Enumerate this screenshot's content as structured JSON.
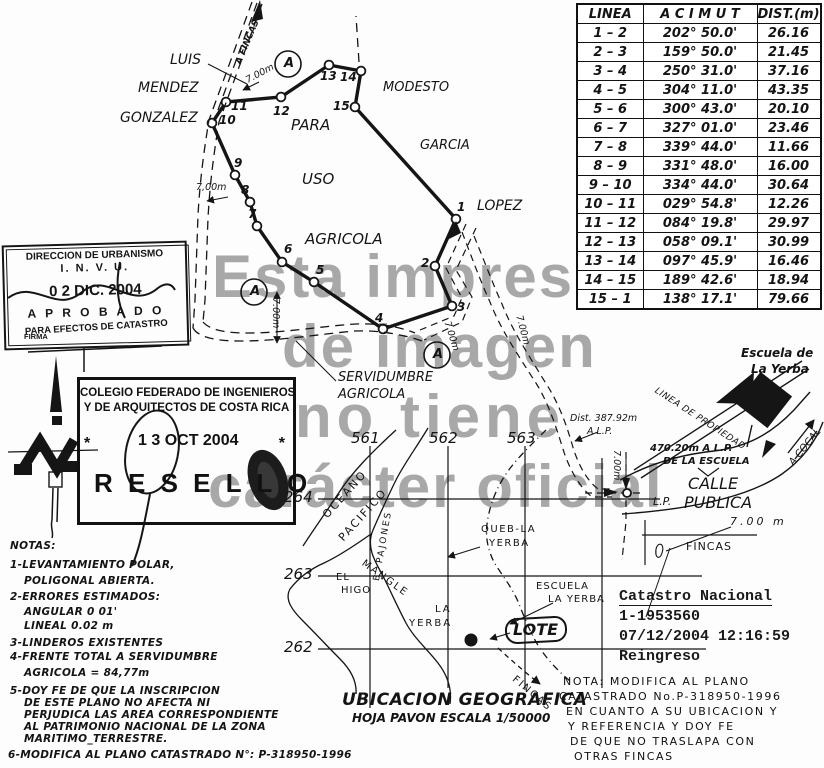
{
  "watermark": {
    "line1": "Esta impresión",
    "line2": "de imagen",
    "line3": "no tiene",
    "line4": "carácter oficial"
  },
  "survey_table": {
    "col_linea": "LINEA",
    "col_acimut": "A C I M U T",
    "col_dist": "DIST.(m)",
    "rows": [
      {
        "linea": "1 – 2",
        "acimut": "202° 50.0'",
        "dist": "26.16"
      },
      {
        "linea": "2 – 3",
        "acimut": "159° 50.0'",
        "dist": "21.45"
      },
      {
        "linea": "3 – 4",
        "acimut": "250° 31.0'",
        "dist": "37.16"
      },
      {
        "linea": "4 – 5",
        "acimut": "304° 11.0'",
        "dist": "43.35"
      },
      {
        "linea": "5 – 6",
        "acimut": "300° 43.0'",
        "dist": "20.10"
      },
      {
        "linea": "6 – 7",
        "acimut": "327° 01.0'",
        "dist": "23.46"
      },
      {
        "linea": "7 – 8",
        "acimut": "339° 44.0'",
        "dist": "11.66"
      },
      {
        "linea": "8 – 9",
        "acimut": "331° 48.0'",
        "dist": "16.00"
      },
      {
        "linea": "9 – 10",
        "acimut": "334° 44.0'",
        "dist": "30.64"
      },
      {
        "linea": "10 – 11",
        "acimut": "029° 54.8'",
        "dist": "12.26"
      },
      {
        "linea": "11 – 12",
        "acimut": "084° 19.8'",
        "dist": "29.97"
      },
      {
        "linea": "12 – 13",
        "acimut": "058° 09.1'",
        "dist": "30.99"
      },
      {
        "linea": "13 – 14",
        "acimut": "097° 45.9'",
        "dist": "16.46"
      },
      {
        "linea": "14 – 15",
        "acimut": "189° 42.6'",
        "dist": "18.94"
      },
      {
        "linea": "15 – 1",
        "acimut": "138° 17.1'",
        "dist": "79.66"
      }
    ]
  },
  "parcel": {
    "vertices": [
      "1",
      "2",
      "3",
      "4",
      "5",
      "6",
      "7",
      "8",
      "9",
      "10",
      "11",
      "12",
      "13",
      "14",
      "15"
    ],
    "marker_a": "A",
    "neighbors": {
      "luis": "LUIS",
      "mendez": "MENDEZ",
      "gonzalez": "GONZALEZ",
      "modesto": "MODESTO",
      "garcia": "GARCIA",
      "lopez": "LOPEZ"
    },
    "use_label": {
      "para": "PARA",
      "uso": "USO",
      "agricola": "AGRICOLA"
    },
    "road_label": "A FINCAS",
    "servidumbre": {
      "line1": "SERVIDUMBRE",
      "line2": "AGRICOLA"
    },
    "dims": {
      "top_road": "7.00m",
      "left": "7,00m",
      "vert_road": "7.00m",
      "edge": "7.00m",
      "path": "7.00m",
      "lp": "7.00m",
      "fincas": "7.00 m"
    },
    "dist_lp": {
      "line1": "Dist.  387.92m",
      "line2": "A L.P."
    },
    "school_dist": {
      "line1": "470.20m A L.P.",
      "line2": "DE LA ESCUELA"
    },
    "calle": {
      "calle": "CALLE",
      "lp": "L.P.",
      "publica": "PUBLICA"
    },
    "a_cocal": "A COCAL",
    "linea_propiedad": "LINEA DE PROPIEDAD",
    "fincas_box": "FINCAS",
    "escuela": {
      "line1": "Escuela de",
      "line2": "La Yerba"
    }
  },
  "stamps": {
    "invu": {
      "line1": "DIRECCION DE URBANISMO",
      "line2": "I. N. V. U.",
      "date": "0 2 DIC. 2004",
      "aprobado": "A P R O B A D O",
      "line4": "PARA EFECTOS DE CATASTRO",
      "firma": "FIRMA"
    },
    "resello": {
      "line1": "COLEGIO FEDERADO DE INGENIEROS",
      "line2": "Y DE ARQUITECTOS DE COSTA RICA",
      "star": "*",
      "date": "1 3 OCT 2004",
      "title": "R E S E L L O"
    }
  },
  "notas": {
    "title": "NOTAS:",
    "l1a": "1-LEVANTAMIENTO POLAR,",
    "l1b": "POLIGONAL ABIERTA.",
    "l2a": "2-ERRORES ESTIMADOS:",
    "l2b": "ANGULAR 0 01'",
    "l2c": "LINEAL 0.02 m",
    "l3": "3-LINDEROS EXISTENTES",
    "l4a": "4-FRENTE TOTAL A SERVIDUMBRE",
    "l4b": "AGRICOLA = 84,77m",
    "l5a": "5-DOY FE DE QUE LA INSCRIPCION",
    "l5b": "DE ESTE PLANO NO AFECTA NI",
    "l5c": "PERJUDICA LAS AREA CORRESPONDIENTE",
    "l5d": "AL PATRIMONIO NACIONAL DE LA ZONA",
    "l5e": "MARITIMO_TERRESTRE.",
    "l6": "6-MODIFICA AL PLANO CATASTRADO N°: P-318950-1996"
  },
  "location_map": {
    "title": "UBICACION GEOGRAFICA",
    "subtitle": "HOJA PAVON ESCALA 1/50000",
    "grid_cols": [
      "561",
      "562",
      "563"
    ],
    "grid_rows": [
      "264",
      "263",
      "262"
    ],
    "features": {
      "oceano1": "OCEANO",
      "oceano2": "PACIFICO",
      "pajones": "B. PAJONES",
      "mangle": "MANGLE",
      "queb1": "QUEB-LA",
      "queb2": "YERBA",
      "elhigo1": "EL",
      "elhigo2": "HIGO",
      "layerba1": "LA",
      "layerba2": "YERBA",
      "escuela1": "ESCUELA",
      "escuela2": "LA YERBA",
      "lote": "LOTE",
      "fincas": "FINCAS"
    }
  },
  "catastro": {
    "line1": "Catastro Nacional",
    "line2": "1-1953560",
    "line3": "07/12/2004 12:16:59",
    "line4": "Reingreso"
  },
  "nota_manuscrita": {
    "l1": "NOTA: MODIFICA AL PLANO",
    "l2": "CATASTRADO No.P-318950-1996",
    "l3": "EN CUANTO A SU UBICACION Y",
    "l4": "Y REFERENCIA Y DOY FE",
    "l5": "DE QUE NO TRASLAPA CON",
    "l6": "OTRAS FINCAS"
  },
  "colors": {
    "ink": "#151515",
    "watermark": "#a8a8a8",
    "paper": "#fdfdfd"
  }
}
